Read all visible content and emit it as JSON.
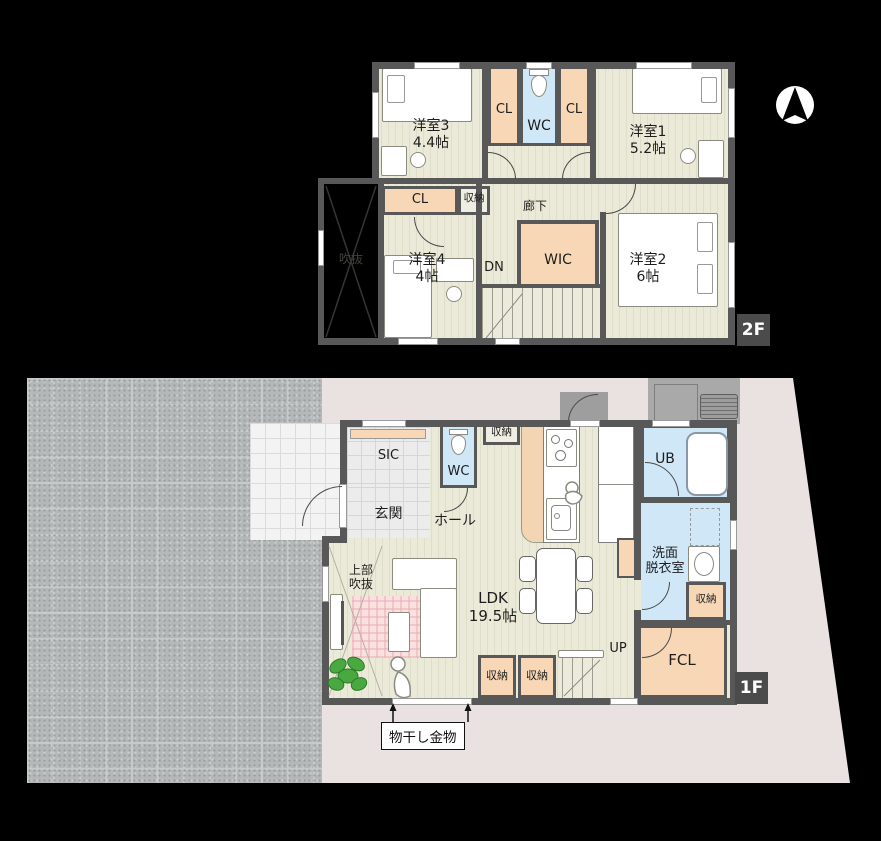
{
  "compass": {
    "icon": "north-arrow"
  },
  "colors": {
    "wall_gray": "#585858",
    "floor_cream": "#ebead9",
    "closet_orange": "#f7d7b6",
    "wet_area_blue": "#cfe7f7",
    "site_pink": "#e9e2e1",
    "pavement_gray": "#b5b8b8",
    "badge_gray": "#4b4b4b",
    "rug_pink": "#fae0e0",
    "plant_green": "#3f9b3a"
  },
  "floor2": {
    "badge": "2F",
    "rooms": {
      "y3name": "洋室3",
      "y3size": "4.4帖",
      "y1name": "洋室1",
      "y1size": "5.2帖",
      "y4name": "洋室4",
      "y4size": "4帖",
      "y2name": "洋室2",
      "y2size": "6帖",
      "cl_left": "CL",
      "cl_right": "CL",
      "cl_mid": "CL",
      "wc": "WC",
      "shunou": "収納",
      "rouka": "廊下",
      "wic": "WIC",
      "dn": "DN",
      "fukinuke": "吹抜"
    }
  },
  "floor1": {
    "badge": "1F",
    "rooms": {
      "sic": "SIC",
      "genkan": "玄関",
      "hall": "ホール",
      "wc": "WC",
      "shunou_hall": "収納",
      "ub": "UB",
      "senmen1": "洗面",
      "senmen2": "脱衣室",
      "shunou_wash": "収納",
      "fcl": "FCL",
      "ldk_name": "LDK",
      "ldk_size": "19.5帖",
      "shunou_a": "収納",
      "shunou_b": "収納",
      "up": "UP",
      "joubu1": "上部",
      "joubu2": "吹抜",
      "monohoshi": "物干し金物"
    }
  }
}
